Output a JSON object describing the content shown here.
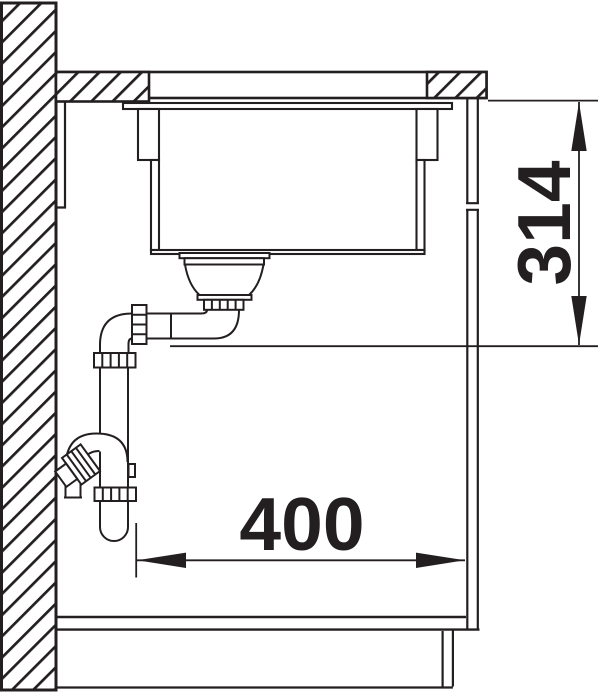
{
  "colors": {
    "ink": "#231f20",
    "paper": "#ffffff"
  },
  "dimensions": {
    "sink_depth": {
      "value": "314"
    },
    "cabinet_width": {
      "value": "400"
    }
  }
}
